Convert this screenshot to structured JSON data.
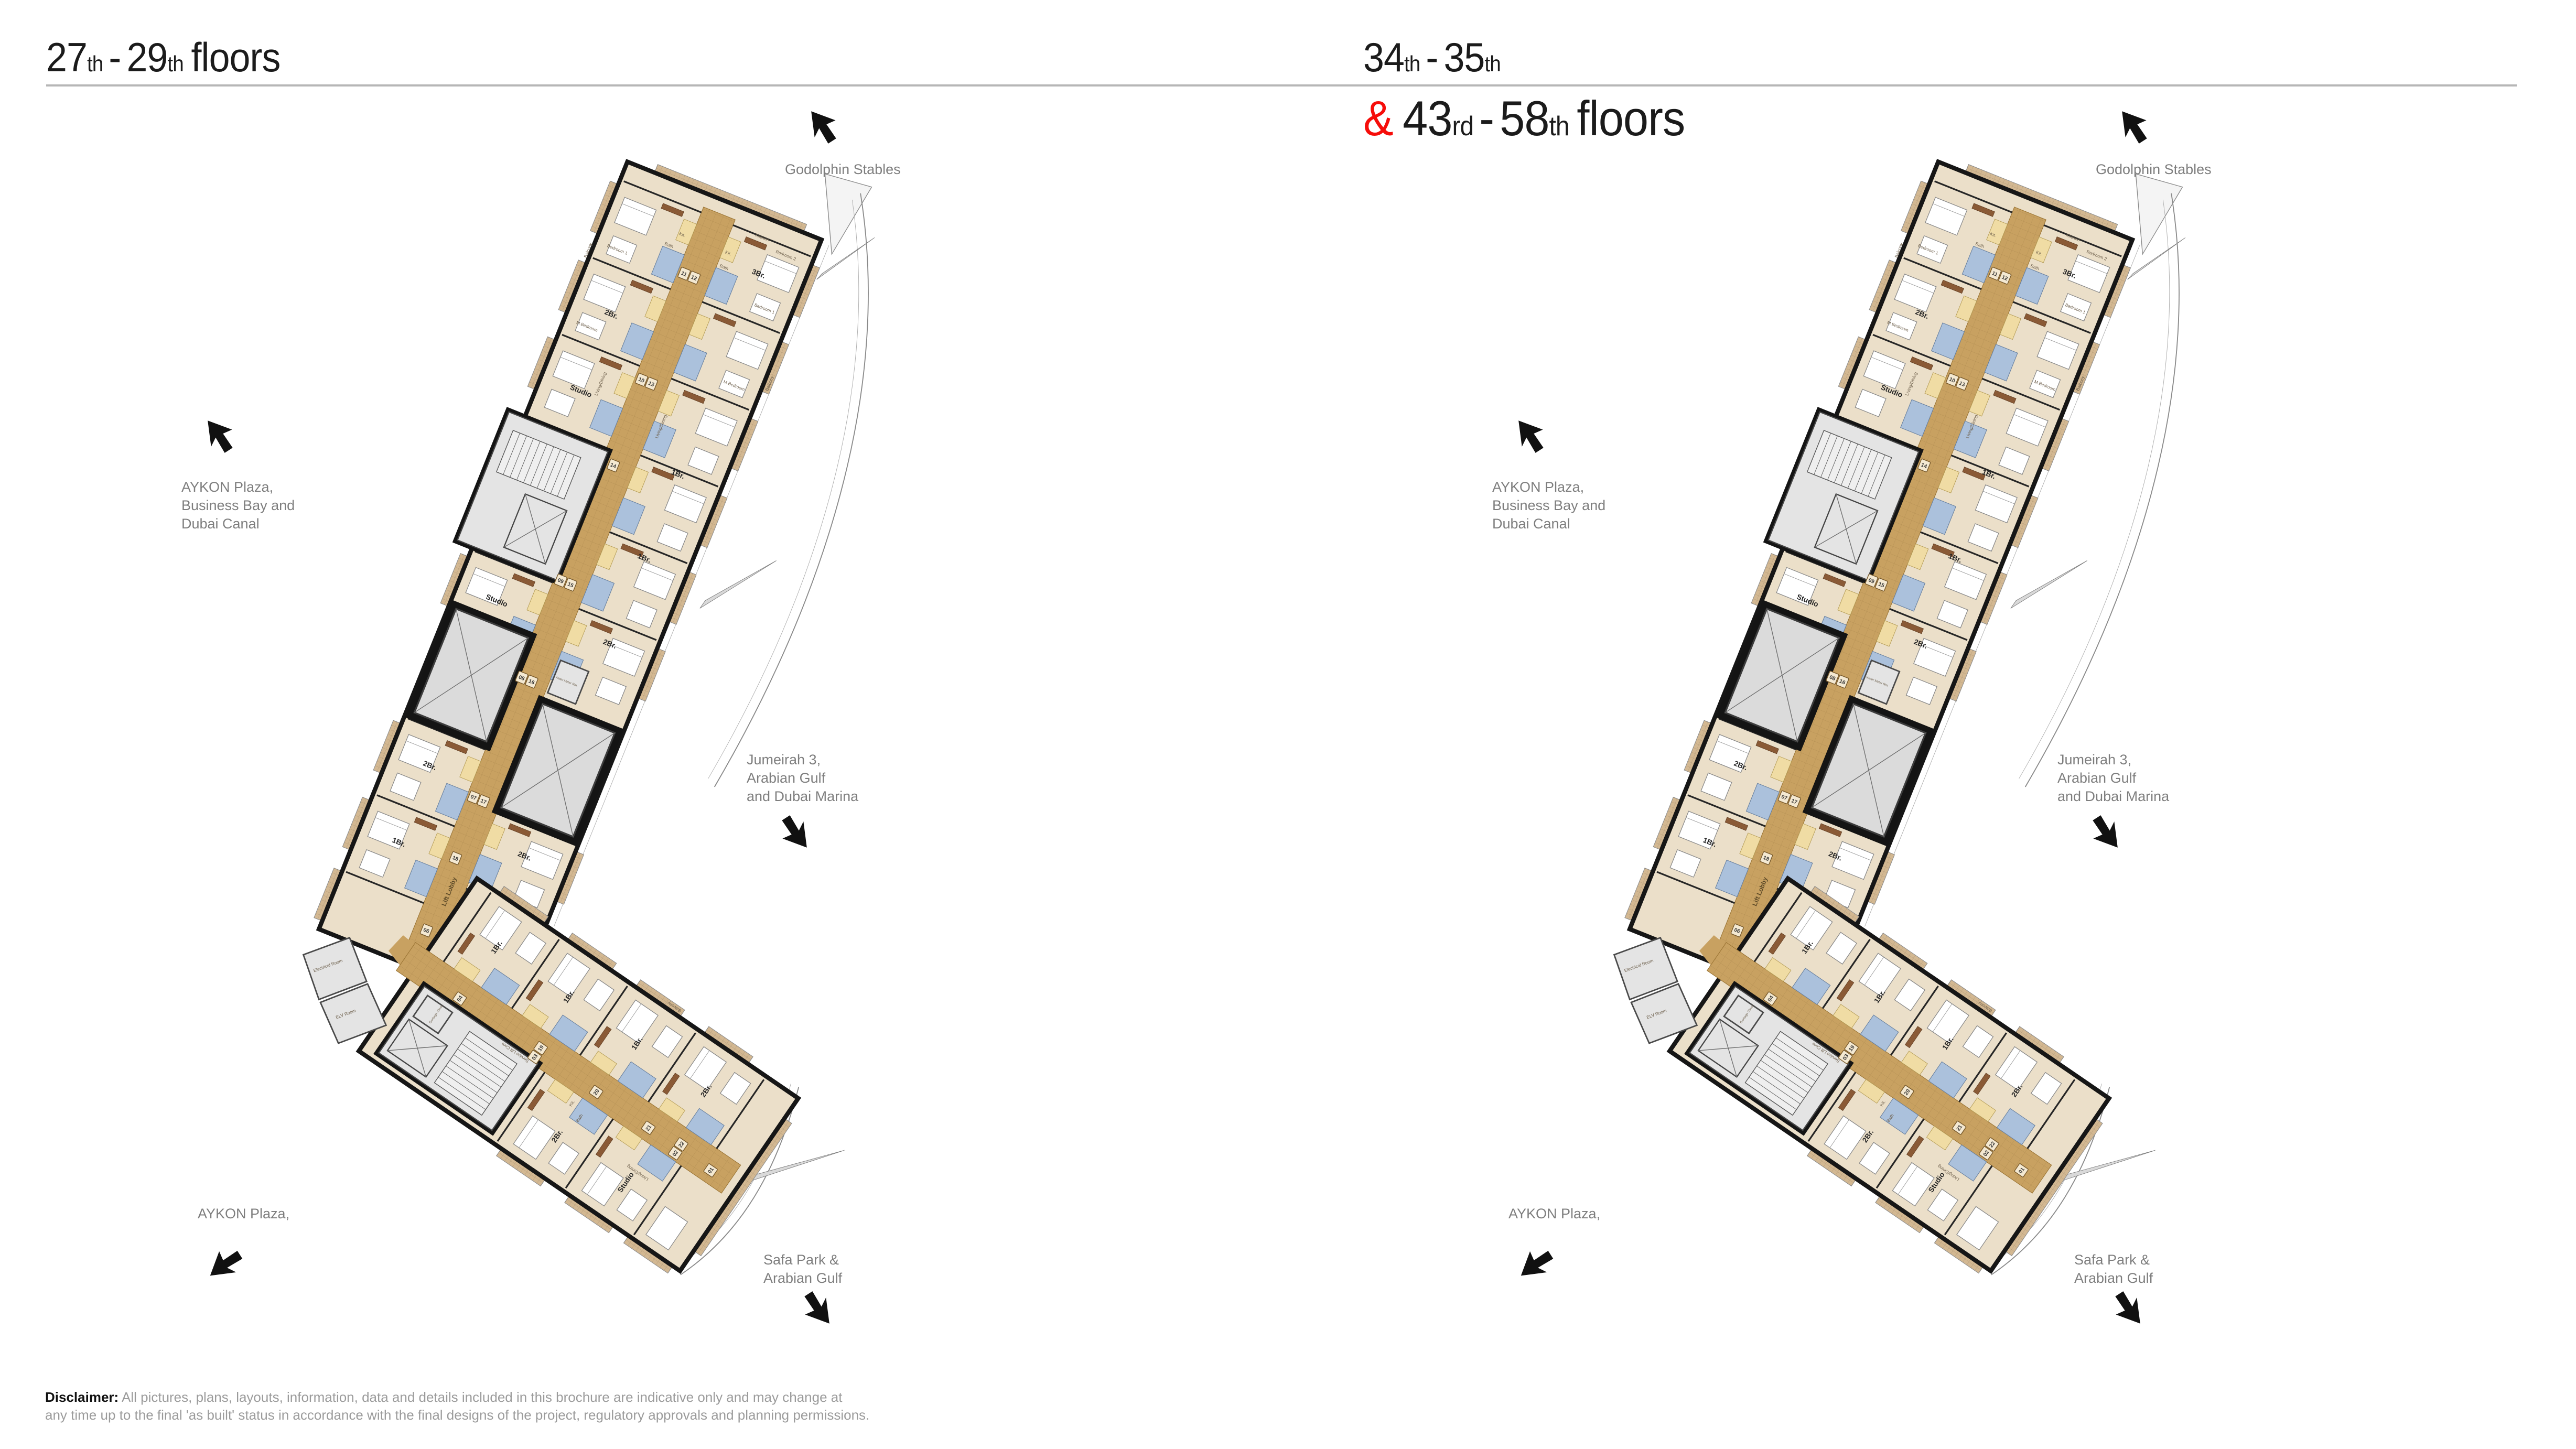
{
  "colors": {
    "accent_red": "#f60d0a",
    "title_black": "#1b1b1b",
    "label_gray": "#7e7e7e",
    "rule_gray": "#b6b6b6",
    "disclaimer_gray": "#9b9b9b",
    "plan_beige": "#EBDFC9",
    "corridor_tan": "#C8A161",
    "balcony_tan": "#D3B892",
    "bath_blue": "#ABC1DC",
    "kitchen_yellow": "#F0DCA4",
    "wood_brown": "#8a5a36",
    "core_gray": "#DBDBDB",
    "wall_black": "#161616"
  },
  "titles": {
    "left": {
      "n1": "27",
      "s1": "th",
      "dash": "-",
      "n2": "29",
      "s2": "th",
      "tail": "floors"
    },
    "right_line1": {
      "n1": "34",
      "s1": "th",
      "dash": "-",
      "n2": "35",
      "s2": "th"
    },
    "right_line2": {
      "amp": "&",
      "n1": "43",
      "s1": "rd",
      "dash": "-",
      "n2": "58",
      "s2": "th",
      "tail": "floors"
    }
  },
  "directions": {
    "godolphin": "Godolphin Stables",
    "aykon_top": [
      "AYKON Plaza,",
      "Business Bay and",
      "Dubai Canal"
    ],
    "jumeirah": [
      "Jumeirah 3,",
      "Arabian Gulf",
      "and Dubai Marina"
    ],
    "aykon_bottom": "AYKON Plaza,",
    "safa": [
      "Safa Park &",
      "Arabian Gulf"
    ]
  },
  "disclaimer": {
    "label": "Disclaimer:",
    "line1": "All pictures, plans, layouts, information, data and details included in this brochure are indicative only and may change at",
    "line2": "any time up to the final 'as built' status in accordance with the final designs of the project, regulatory approvals and planning permissions."
  },
  "plan": {
    "rooms": {
      "balcony": "Balcony",
      "bedroom1": "Bedroom 1",
      "bedroom2": "Bedroom 2",
      "mbedroom": "M.Bedroom",
      "living": "Living/Dining",
      "kitchen": "Kitchen",
      "kit": "Kit.",
      "bath": "Bath",
      "lift_lobby": "Lift Lobby",
      "service": "Service Lift Core",
      "garbage": "Garbage Chute",
      "water": "Water Meter Rm.",
      "electrical": "Electrical Room",
      "elv": "ELV Room"
    },
    "unit_types": {
      "u3br": "3Br.",
      "u2br": "2Br.",
      "u1br": "1Br.",
      "studio": "Studio"
    },
    "chips_main": [
      [
        "11",
        "12"
      ],
      [
        "10",
        "13"
      ],
      [
        "14"
      ],
      [
        "09",
        "15"
      ],
      [
        "08",
        "16"
      ],
      [
        "07",
        "17"
      ],
      [
        "18"
      ],
      [
        "06"
      ]
    ],
    "chips_lower": [
      [
        "04"
      ],
      [
        "03",
        "19"
      ],
      [
        "20"
      ],
      [
        "21"
      ],
      [
        "02",
        "22"
      ],
      [
        "01"
      ]
    ]
  }
}
